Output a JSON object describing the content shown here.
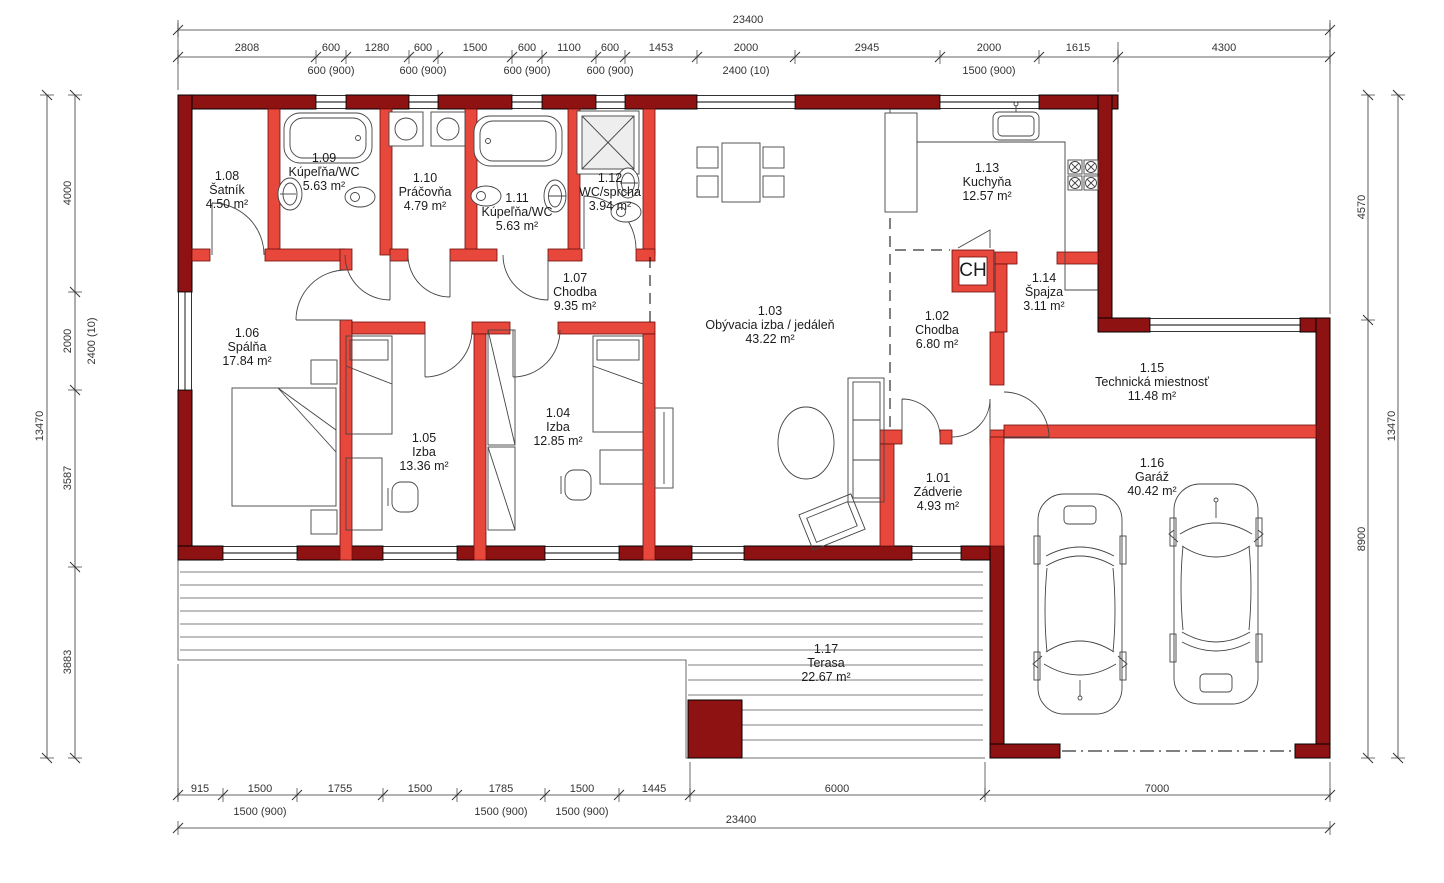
{
  "chimney_label": "CH",
  "colors": {
    "exterior_wall": "#8e1212",
    "interior_wall": "#e8483c"
  },
  "rooms": [
    {
      "number": "1.01",
      "name": "Zádverie",
      "area": "4.93 m²"
    },
    {
      "number": "1.02",
      "name": "Chodba",
      "area": "6.80 m²"
    },
    {
      "number": "1.03",
      "name": "Obývacia izba / jedáleň",
      "area": "43.22 m²"
    },
    {
      "number": "1.04",
      "name": "Izba",
      "area": "12.85 m²"
    },
    {
      "number": "1.05",
      "name": "Izba",
      "area": "13.36 m²"
    },
    {
      "number": "1.06",
      "name": "Spálňa",
      "area": "17.84 m²"
    },
    {
      "number": "1.07",
      "name": "Chodba",
      "area": "9.35 m²"
    },
    {
      "number": "1.08",
      "name": "Šatník",
      "area": "4.50 m²"
    },
    {
      "number": "1.09",
      "name": "Kúpeľňa/WC",
      "area": "5.63 m²"
    },
    {
      "number": "1.10",
      "name": "Práčovňa",
      "area": "4.79 m²"
    },
    {
      "number": "1.11",
      "name": "Kúpeľňa/WC",
      "area": "5.63 m²"
    },
    {
      "number": "1.12",
      "name": "WC/sprcha",
      "area": "3.94 m²"
    },
    {
      "number": "1.13",
      "name": "Kuchyňa",
      "area": "12.57 m²"
    },
    {
      "number": "1.14",
      "name": "Špajza",
      "area": "3.11 m²"
    },
    {
      "number": "1.15",
      "name": "Technická miestnosť",
      "area": "11.48 m²"
    },
    {
      "number": "1.16",
      "name": "Garáž",
      "area": "40.42 m²"
    },
    {
      "number": "1.17",
      "name": "Terasa",
      "area": "22.67 m²"
    }
  ],
  "dimensions": {
    "top": {
      "total": "23400",
      "segments": [
        "2808",
        "600",
        "1280",
        "600",
        "1500",
        "600",
        "1100",
        "600",
        "1453",
        "2000",
        "2945",
        "2000",
        "1615",
        "4300"
      ],
      "sub": [
        "600 (900)",
        "600 (900)",
        "600 (900)",
        "600 (900)",
        "2400 (10)",
        "1500 (900)"
      ]
    },
    "bottom": {
      "total": "23400",
      "segments": [
        "915",
        "1500",
        "1755",
        "1500",
        "1785",
        "1500",
        "1445",
        "6000",
        "7000"
      ],
      "sub": [
        "1500 (900)",
        "1500 (900)",
        "1500 (900)"
      ]
    },
    "left": {
      "total": "13470",
      "segments": [
        "4000",
        "2000",
        "3587",
        "3883"
      ],
      "extra": "2400 (10)"
    },
    "right": {
      "total": "13470",
      "segments": [
        "4570",
        "8900"
      ]
    }
  }
}
